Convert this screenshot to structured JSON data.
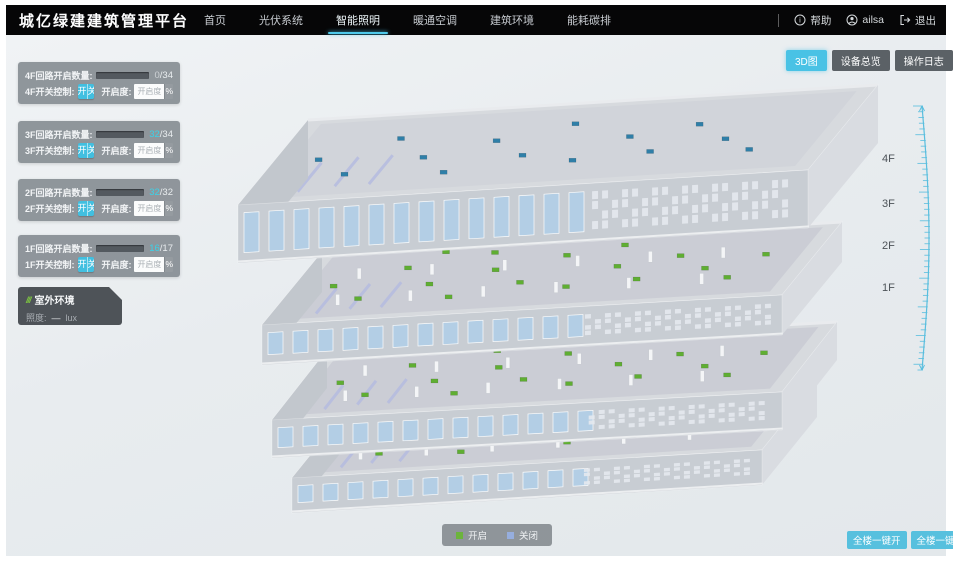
{
  "header": {
    "title": "城亿绿建建筑管理平台",
    "nav": [
      {
        "label": "首页",
        "active": false
      },
      {
        "label": "光伏系统",
        "active": false
      },
      {
        "label": "智能照明",
        "active": true
      },
      {
        "label": "暖通空调",
        "active": false
      },
      {
        "label": "建筑环境",
        "active": false
      },
      {
        "label": "能耗碳排",
        "active": false
      }
    ],
    "help_label": "帮助",
    "user_name": "ailsa",
    "logout_label": "退出"
  },
  "view_buttons": [
    {
      "label": "3D图",
      "active": true
    },
    {
      "label": "设备总览",
      "active": false
    },
    {
      "label": "操作日志",
      "active": false
    }
  ],
  "floor_panels": [
    {
      "floor": "4F",
      "count_label": "4F回路开启数量:",
      "open": "0",
      "sep": "/",
      "total": "34",
      "switch_label": "4F开关控制:",
      "on_label": "开",
      "off_label": "关",
      "dimmer_label": "开启度:",
      "dimmer_placeholder": "开启度",
      "percent_label": "%"
    },
    {
      "floor": "3F",
      "count_label": "3F回路开启数量:",
      "open": "32",
      "sep": "/",
      "total": "34",
      "switch_label": "3F开关控制:",
      "on_label": "开",
      "off_label": "关",
      "dimmer_label": "开启度:",
      "dimmer_placeholder": "开启度",
      "percent_label": "%"
    },
    {
      "floor": "2F",
      "count_label": "2F回路开启数量:",
      "open": "32",
      "sep": "/",
      "total": "32",
      "switch_label": "2F开关控制:",
      "on_label": "开",
      "off_label": "关",
      "dimmer_label": "开启度:",
      "dimmer_placeholder": "开启度",
      "percent_label": "%"
    },
    {
      "floor": "1F",
      "count_label": "1F回路开启数量:",
      "open": "16",
      "sep": "/",
      "total": "17",
      "switch_label": "1F开关控制:",
      "on_label": "开",
      "off_label": "关",
      "dimmer_label": "开启度:",
      "dimmer_placeholder": "开启度",
      "percent_label": "%"
    }
  ],
  "outdoor_panel": {
    "icon": "slashes-icon",
    "title": "室外环境",
    "metric_label": "照度:",
    "metric_value": "—",
    "metric_unit": "lux"
  },
  "floor_markers": [
    {
      "label": "4F"
    },
    {
      "label": "3F"
    },
    {
      "label": "2F"
    },
    {
      "label": "1F"
    }
  ],
  "legend": {
    "on_label": "开启",
    "on_color": "#6cb43c",
    "off_label": "关闭",
    "off_color": "#96aede"
  },
  "bottom_buttons": [
    {
      "label": "全楼一键开"
    },
    {
      "label": "全楼一键关"
    }
  ],
  "colors": {
    "accent": "#49c2e5",
    "ruler": "#58bede",
    "light_on": "#5fae32",
    "light_off": "#2f7fa8"
  }
}
